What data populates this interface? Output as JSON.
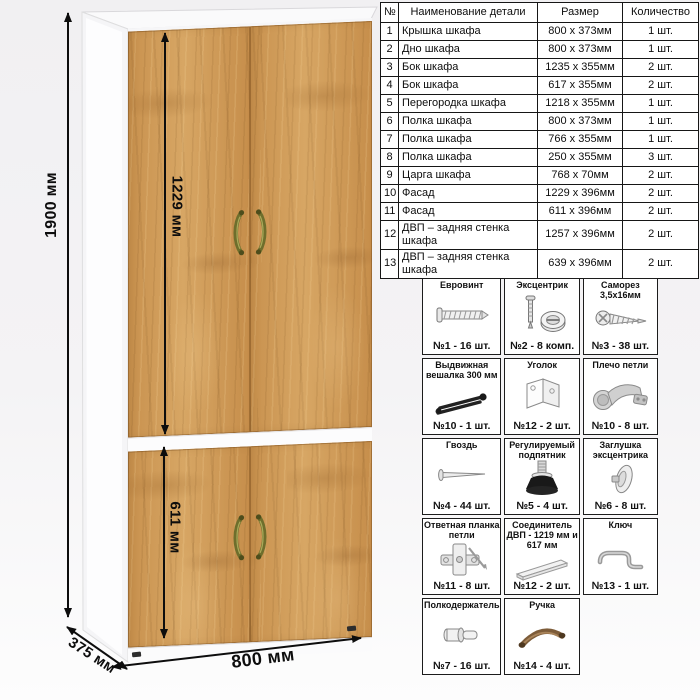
{
  "dimensions": {
    "total_height": "1900 мм",
    "upper_doors_height": "1229 мм",
    "lower_doors_height": "611 мм",
    "width": "800 мм",
    "depth": "375 мм"
  },
  "parts_table": {
    "headers": [
      "№",
      "Наименование детали",
      "Размер",
      "Количество"
    ],
    "rows": [
      {
        "num": "1",
        "name": "Крышка шкафа",
        "size": "800 x 373мм",
        "qty": "1 шт."
      },
      {
        "num": "2",
        "name": "Дно шкафа",
        "size": "800 x 373мм",
        "qty": "1 шт."
      },
      {
        "num": "3",
        "name": "Бок шкафа",
        "size": "1235 x 355мм",
        "qty": "2 шт."
      },
      {
        "num": "4",
        "name": "Бок шкафа",
        "size": "617 x 355мм",
        "qty": "2 шт."
      },
      {
        "num": "5",
        "name": "Перегородка шкафа",
        "size": "1218 x 355мм",
        "qty": "1 шт."
      },
      {
        "num": "6",
        "name": "Полка шкафа",
        "size": "800 x 373мм",
        "qty": "1 шт."
      },
      {
        "num": "7",
        "name": "Полка шкафа",
        "size": "766 x 355мм",
        "qty": "1 шт."
      },
      {
        "num": "8",
        "name": "Полка шкафа",
        "size": "250 x 355мм",
        "qty": "3 шт."
      },
      {
        "num": "9",
        "name": "Царга шкафа",
        "size": "768 x 70мм",
        "qty": "2 шт."
      },
      {
        "num": "10",
        "name": "Фасад",
        "size": "1229 x 396мм",
        "qty": "2 шт."
      },
      {
        "num": "11",
        "name": "Фасад",
        "size": "611 x 396мм",
        "qty": "2 шт."
      },
      {
        "num": "12",
        "name": "ДВП – задняя стенка шкафа",
        "size": "1257 x 396мм",
        "qty": "2 шт."
      },
      {
        "num": "13",
        "name": "ДВП – задняя стенка шкафа",
        "size": "639 x 396мм",
        "qty": "2 шт."
      }
    ]
  },
  "hardware": {
    "items": [
      {
        "title": "Евровинт",
        "count": "№1 - 16 шт.",
        "icon": "euro-screw-icon"
      },
      {
        "title": "Эксцентрик",
        "count": "№2 - 8 комп.",
        "icon": "eccentric-cam-icon"
      },
      {
        "title": "Саморез 3,5х16мм",
        "count": "№3 - 38 шт.",
        "icon": "self-tapping-screw-icon"
      },
      {
        "title": "Выдвижная вешалка 300 мм",
        "count": "№10 - 1 шт.",
        "icon": "pullout-hanger-icon"
      },
      {
        "title": "Уголок",
        "count": "№12 - 2 шт.",
        "icon": "corner-bracket-icon"
      },
      {
        "title": "Плечо петли",
        "count": "№10 - 8 шт.",
        "icon": "hinge-arm-icon"
      },
      {
        "title": "Гвоздь",
        "count": "№4 - 44 шт.",
        "icon": "nail-icon"
      },
      {
        "title": "Регулируемый подпятник",
        "count": "№5 - 4 шт.",
        "icon": "adjustable-foot-icon"
      },
      {
        "title": "Заглушка эксцентрика",
        "count": "№6 - 8 шт.",
        "icon": "cam-cover-icon"
      },
      {
        "title": "Ответная планка петли",
        "count": "№11 - 8 шт.",
        "icon": "hinge-plate-icon"
      },
      {
        "title": "Соединитель ДВП - 1219 мм и 617 мм",
        "count": "№12 - 2 шт.",
        "icon": "hdf-connector-icon"
      },
      {
        "title": "Ключ",
        "count": "№13 - 1 шт.",
        "icon": "hex-key-icon"
      },
      {
        "title": "Полкодержатель",
        "count": "№7 - 16 шт.",
        "icon": "shelf-pin-icon"
      },
      {
        "title": "Ручка",
        "count": "№14 - 4 шт.",
        "icon": "handle-icon"
      }
    ]
  },
  "colors": {
    "wood": "#cd9655",
    "carcass_white": "#fbfbfc",
    "handle_brass": "#76762e",
    "dimension_text": "#0d0d0d"
  }
}
